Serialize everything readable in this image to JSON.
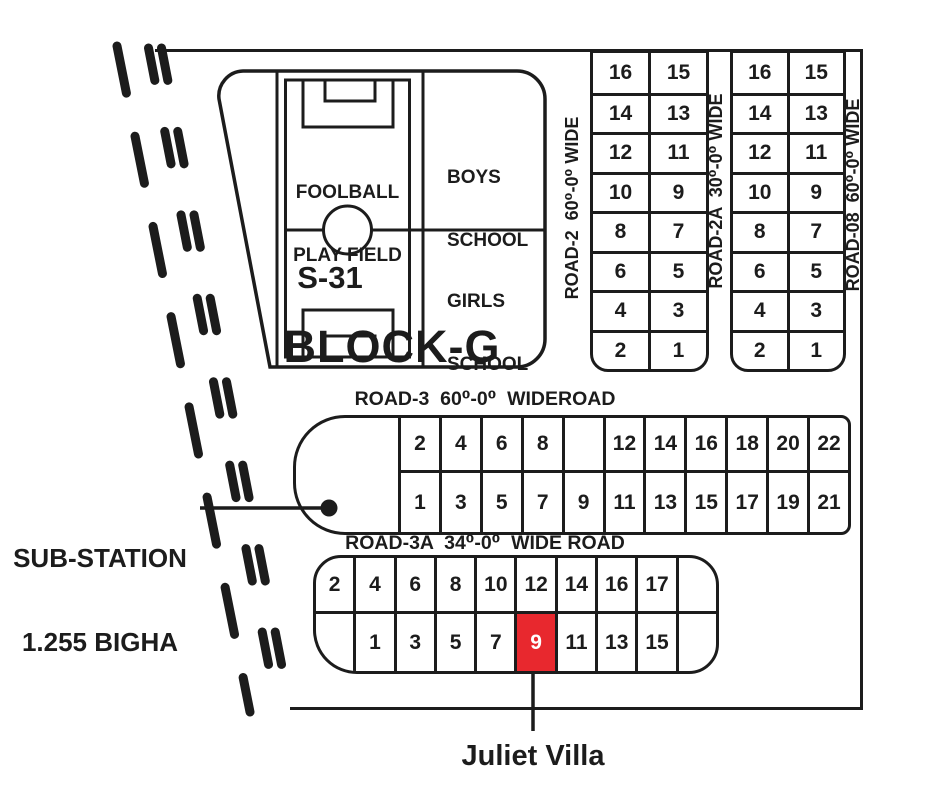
{
  "palette": {
    "ink": "#1c1c1c",
    "highlight": "#e8282e",
    "highlight_text": "#ffffff",
    "bg": "#ffffff"
  },
  "block": {
    "title": "BLOCK-G",
    "field": {
      "name_line1": "FOOLBALL",
      "name_line2": "PLAY FIELD",
      "plot_id": "S-31"
    },
    "boys_school": {
      "line1": "BOYS",
      "line2": "SCHOOL"
    },
    "girls_school": {
      "line1": "GIRLS",
      "line2": "SCHOOL"
    }
  },
  "roads": {
    "road2": {
      "label": "ROAD-2  60⁰-0⁰ WIDE"
    },
    "road2a": {
      "label": "ROAD-2A  30⁰-0⁰ WIDE"
    },
    "road08": {
      "label": "ROAD-08  60⁰-0⁰ WIDE"
    },
    "road3": {
      "label": "ROAD-3  60⁰-0⁰  WIDEROAD"
    },
    "road3a": {
      "label": "ROAD-3A  34⁰-0⁰  WIDE ROAD"
    }
  },
  "substation": {
    "line1": "SUB-STATION",
    "line2": "1.255 BIGHA"
  },
  "callout": {
    "label": "Juliet Villa",
    "target_plot": "9"
  },
  "plot_grids": {
    "east_block_a": {
      "rows": [
        [
          "16",
          "15"
        ],
        [
          "14",
          "13"
        ],
        [
          "12",
          "11"
        ],
        [
          "10",
          "9"
        ],
        [
          "8",
          "7"
        ],
        [
          "6",
          "5"
        ],
        [
          "4",
          "3"
        ],
        [
          "2",
          "1"
        ]
      ]
    },
    "east_block_b": {
      "rows": [
        [
          "16",
          "15"
        ],
        [
          "14",
          "13"
        ],
        [
          "12",
          "11"
        ],
        [
          "10",
          "9"
        ],
        [
          "8",
          "7"
        ],
        [
          "6",
          "5"
        ],
        [
          "4",
          "3"
        ],
        [
          "2",
          "1"
        ]
      ]
    },
    "road3_block": {
      "rows": [
        [
          "2",
          "4",
          "6",
          "8",
          "",
          "12",
          "14",
          "16",
          "18",
          "20",
          "22"
        ],
        [
          "1",
          "3",
          "5",
          "7",
          "9",
          "11",
          "13",
          "15",
          "17",
          "19",
          "21"
        ]
      ]
    },
    "road3a_block": {
      "rows": [
        [
          "2",
          "4",
          "6",
          "8",
          "10",
          "12",
          "14",
          "16",
          "17",
          ""
        ],
        [
          "",
          "1",
          "3",
          "5",
          "7",
          "9",
          "11",
          "13",
          "15",
          ""
        ]
      ],
      "highlight": {
        "row": 1,
        "col": 5,
        "value": "9"
      }
    }
  }
}
